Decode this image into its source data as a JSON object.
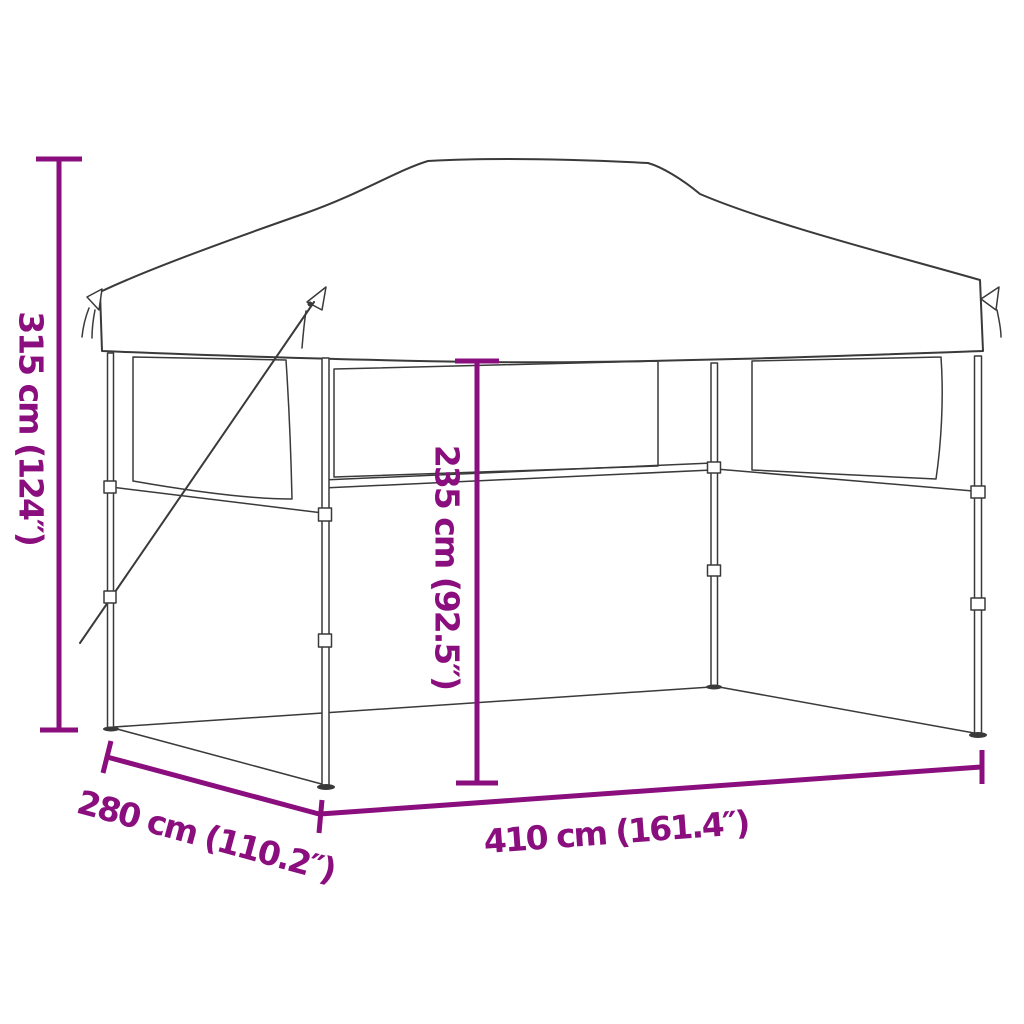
{
  "image": {
    "background_color": "#FFFFFF",
    "accent_color": "#8A0E7E",
    "line_color": "#3A3A3A",
    "dimensions": {
      "total_height": {
        "label": "315 cm (124″)",
        "cm": 315,
        "inches": 124
      },
      "side_height": {
        "label": "235 cm (92.5″)",
        "cm": 235,
        "inches": 92.5
      },
      "width": {
        "label": "410 cm (161.4″)",
        "cm": 410,
        "inches": 161.4
      },
      "depth": {
        "label": "280 cm (110.2″)",
        "cm": 280,
        "inches": 110.2
      }
    }
  }
}
